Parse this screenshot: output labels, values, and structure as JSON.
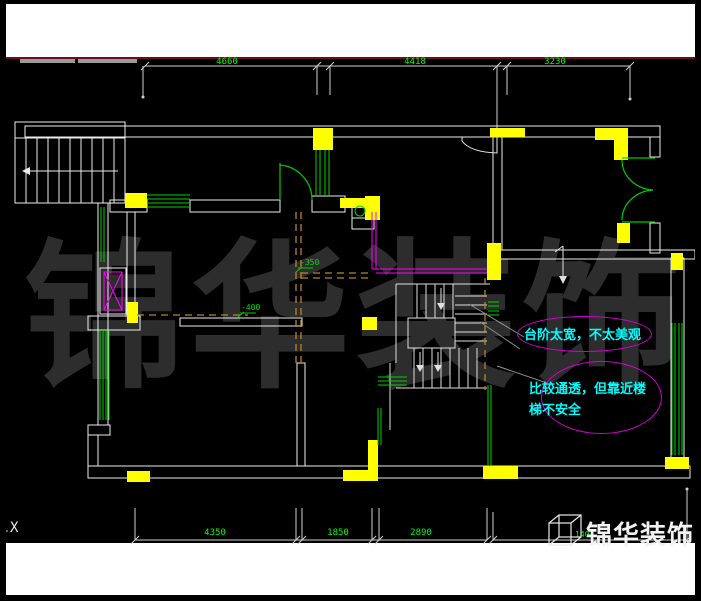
{
  "window": {
    "type": "cad-floor-plan-screenshot"
  },
  "axis_label": "X",
  "watermark": {
    "text": "锦华装饰",
    "color": "#2d2d2d"
  },
  "logo": {
    "text": "锦华装饰",
    "icon": "cube-wireframe-icon",
    "color": "#f2f2f2"
  },
  "dims": {
    "top": [
      "4660",
      "4418",
      "3230"
    ],
    "bottom": [
      "4350",
      "1850",
      "2890",
      "140"
    ],
    "levels": [
      "-350",
      "-400"
    ]
  },
  "annotations": [
    {
      "text": "台阶太宽，不太美观",
      "shape": "ellipse",
      "stroke": "#d400d4",
      "text_color": "#00ffff"
    },
    {
      "text": "比较通透，但靠近楼梯不安全",
      "shape": "ellipse",
      "stroke": "#d400d4",
      "text_color": "#00ffff"
    }
  ],
  "colors": {
    "background": "#000000",
    "paper_band": "#ffffff",
    "maroon_rule": "#6a0f1e",
    "walls": "#ececec",
    "columns": "#ffff00",
    "windows": "#00d400",
    "doors": "#00cc00",
    "dimension_text": "#00ff00",
    "revision_magenta": "#ff00ff",
    "demolition_dashed": "#b5852e",
    "annotation_cyan": "#00ffff"
  }
}
